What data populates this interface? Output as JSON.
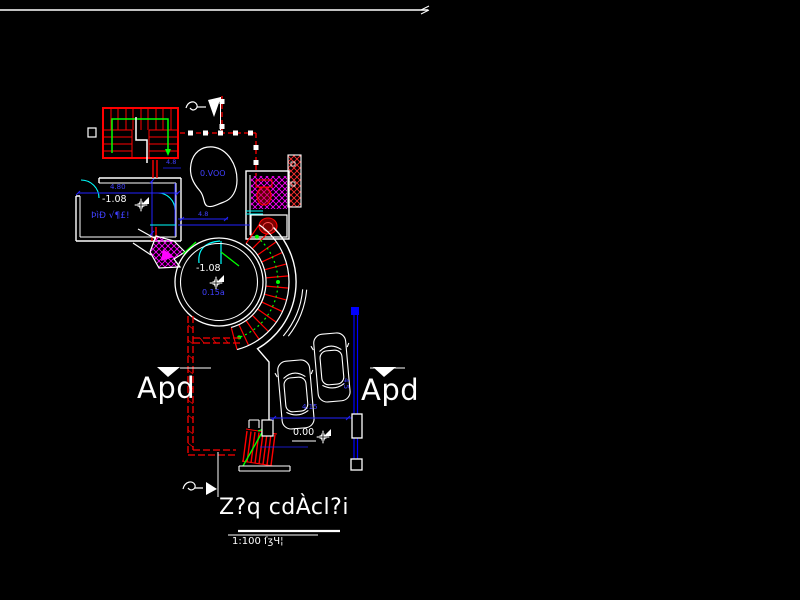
{
  "app": {
    "name": "CAD floor plan viewport"
  },
  "colors": {
    "background": "#000000",
    "walls": "#ffffff",
    "stairs_red": "#ff0000",
    "dimension_blue": "#2222ff",
    "door_cyan": "#00ffff",
    "path_green": "#00ff00",
    "tile_magenta": "#ff00ff"
  },
  "labels": {
    "room_width_dim": "4.80",
    "room_small_dim": "4.8",
    "room_level": "-1.08",
    "room_name": "ÞìÐ √¶£!",
    "garden_label": "0.VOO",
    "mid_dim": "4.8",
    "hall_level": "-1.08",
    "hall_name": "0.15a",
    "parking_width_dim": "4.15",
    "parking_height_dim": "4.5",
    "ground_level": "0.00",
    "section_marker_left": "Apd",
    "section_marker_right": "Apd",
    "title": "Z?q cdÀcl?i",
    "scale_note": "1:100 ſʒЧ¦"
  },
  "icons": {
    "level_marker": "four-point-star-with-flag",
    "section_cut": "filled-triangle-down",
    "north_flag": "flag-on-pole",
    "break_mark": "squiggle"
  }
}
